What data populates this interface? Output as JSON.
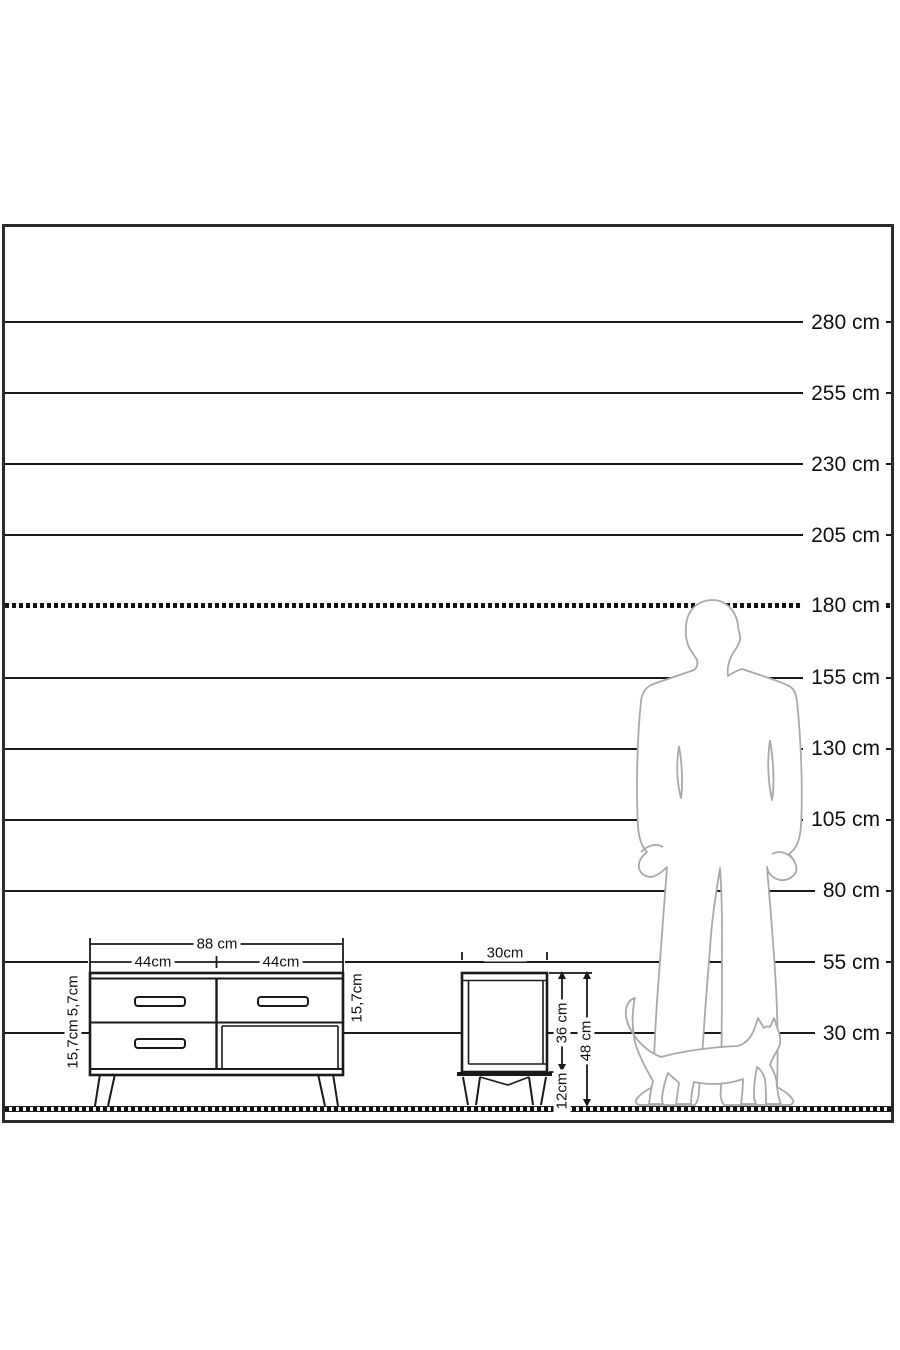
{
  "title": "furniture-height-scale-diagram",
  "ruler": {
    "unit": "cm",
    "ground_y": 1109,
    "px_per_cm": 2.8444,
    "frame_inner_top": 227,
    "lines": [
      {
        "cm": 280,
        "label": "280 cm",
        "dashed": false
      },
      {
        "cm": 255,
        "label": "255 cm",
        "dashed": false
      },
      {
        "cm": 230,
        "label": "230 cm",
        "dashed": false
      },
      {
        "cm": 205,
        "label": "205 cm",
        "dashed": false
      },
      {
        "cm": 180,
        "label": "180 cm",
        "dashed": true
      },
      {
        "cm": 155,
        "label": "155 cm",
        "dashed": false
      },
      {
        "cm": 130,
        "label": "130 cm",
        "dashed": false
      },
      {
        "cm": 105,
        "label": "105 cm",
        "dashed": false
      },
      {
        "cm": 80,
        "label": "80 cm",
        "dashed": false
      },
      {
        "cm": 55,
        "label": "55 cm",
        "dashed": false
      },
      {
        "cm": 30,
        "label": "30 cm",
        "dashed": false
      }
    ]
  },
  "dresser": {
    "width_label": "88 cm",
    "left_half_label": "44cm",
    "right_half_label": "44cm",
    "drawer_left_top_label": "15,7cm",
    "drawer_left_bottom_label": "15,7cm",
    "drawer_right_top_label": "15,7cm"
  },
  "nightstand": {
    "width_label": "30cm",
    "body_height_label": "36 cm",
    "leg_height_label": "12cm",
    "total_height_label": "48 cm"
  },
  "figures": {
    "man": "man-silhouette",
    "cat": "cat-silhouette"
  },
  "colors": {
    "line": "#1a1a1a",
    "frame_border": "#2b2b2b",
    "figure_outline": "#a9a9a9",
    "background": "#ffffff"
  }
}
